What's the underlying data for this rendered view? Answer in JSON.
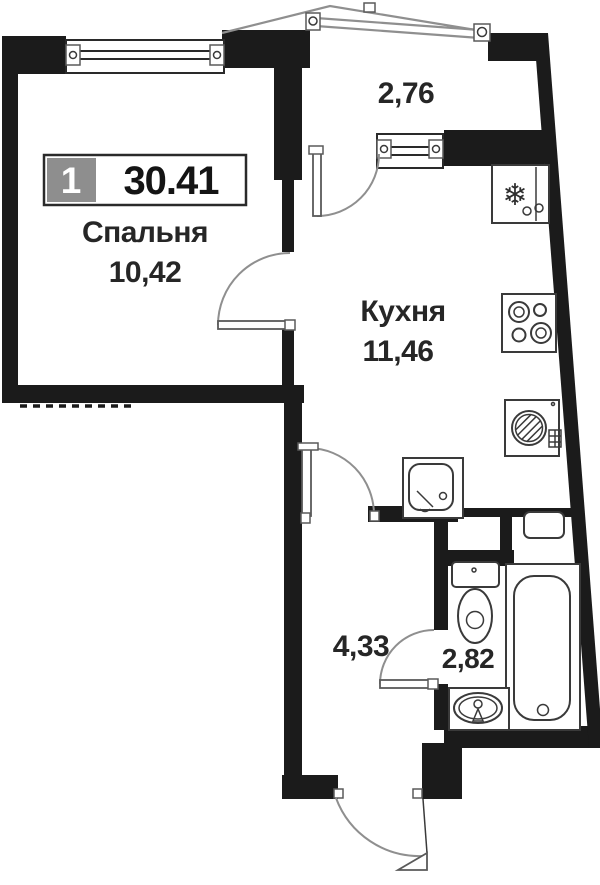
{
  "plan": {
    "title_badge": {
      "unit": "1",
      "total_area": "30.41"
    },
    "rooms": {
      "bedroom": {
        "name": "Спальня",
        "area": "10,42"
      },
      "kitchen": {
        "name": "Кухня",
        "area": "11,46"
      },
      "balcony": {
        "area": "2,76"
      },
      "hallway": {
        "area": "4,33"
      },
      "bathroom": {
        "area": "2,82"
      }
    },
    "icons": {
      "snowflake": "❄"
    },
    "colors": {
      "wall": "#1b1b1b",
      "fixture_line": "#3a3a3a",
      "door_arc": "#8f8f8f",
      "balcony_line": "#8f8f8f",
      "badge_grey": "#8e8e8e",
      "text": "#262626",
      "background": "#ffffff"
    }
  }
}
